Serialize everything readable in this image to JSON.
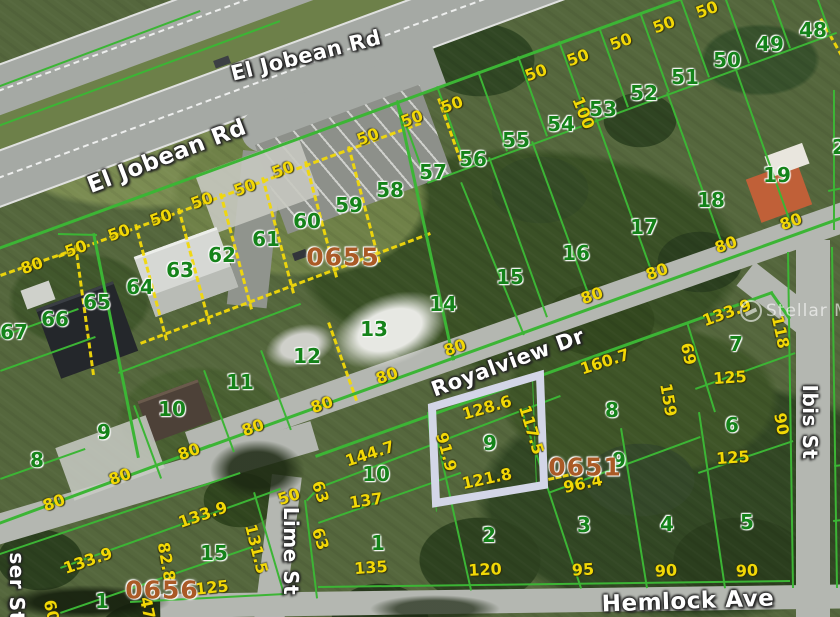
{
  "map": {
    "watermark": {
      "text": "Stellar MLS"
    },
    "colors": {
      "parcel_line_green": "#3cb535",
      "dimension_yellow": "#f2d806",
      "lot_number_green": "#15831a",
      "block_number_brown": "#aa5a26",
      "highlight_border": "#d3d6e7"
    },
    "highlight": {
      "points": "432,407 540,375 544,485 436,503",
      "color": "#d3d6e7",
      "lot": "9"
    },
    "streets": [
      {
        "t": "El Jobean Rd",
        "x": 306,
        "y": 56,
        "r": -14,
        "s": 21
      },
      {
        "t": "El Jobean Rd",
        "x": 167,
        "y": 157,
        "r": -21,
        "s": 23
      },
      {
        "t": "Royalview Dr",
        "x": 508,
        "y": 363,
        "r": -20,
        "s": 21
      },
      {
        "t": "Hemlock Ave",
        "x": 688,
        "y": 602,
        "r": -2,
        "s": 23
      },
      {
        "t": "Lime St",
        "x": 291,
        "y": 551,
        "r": 90,
        "s": 20
      },
      {
        "t": "Ibis St",
        "x": 810,
        "y": 422,
        "r": 90,
        "s": 20
      },
      {
        "t": "ser St",
        "x": 17,
        "y": 587,
        "r": 90,
        "s": 20
      }
    ],
    "block_numbers": [
      {
        "t": "0655",
        "x": 343,
        "y": 257
      },
      {
        "t": "0651",
        "x": 585,
        "y": 467
      },
      {
        "t": "0656",
        "x": 162,
        "y": 590
      }
    ],
    "lot_numbers": [
      {
        "n": "48",
        "x": 813,
        "y": 30
      },
      {
        "n": "49",
        "x": 770,
        "y": 44
      },
      {
        "n": "50",
        "x": 727,
        "y": 60
      },
      {
        "n": "51",
        "x": 685,
        "y": 77
      },
      {
        "n": "52",
        "x": 644,
        "y": 93
      },
      {
        "n": "53",
        "x": 603,
        "y": 109
      },
      {
        "n": "54",
        "x": 561,
        "y": 124
      },
      {
        "n": "55",
        "x": 516,
        "y": 140
      },
      {
        "n": "56",
        "x": 473,
        "y": 159
      },
      {
        "n": "57",
        "x": 433,
        "y": 172
      },
      {
        "n": "58",
        "x": 390,
        "y": 190
      },
      {
        "n": "59",
        "x": 349,
        "y": 205
      },
      {
        "n": "60",
        "x": 307,
        "y": 221
      },
      {
        "n": "61",
        "x": 266,
        "y": 239
      },
      {
        "n": "62",
        "x": 222,
        "y": 255
      },
      {
        "n": "63",
        "x": 180,
        "y": 270
      },
      {
        "n": "64",
        "x": 140,
        "y": 287
      },
      {
        "n": "65",
        "x": 97,
        "y": 302
      },
      {
        "n": "66",
        "x": 55,
        "y": 319
      },
      {
        "n": "67",
        "x": 14,
        "y": 332
      },
      {
        "n": "19",
        "x": 777,
        "y": 175
      },
      {
        "n": "18",
        "x": 711,
        "y": 200
      },
      {
        "n": "17",
        "x": 644,
        "y": 227
      },
      {
        "n": "16",
        "x": 576,
        "y": 253
      },
      {
        "n": "15",
        "x": 510,
        "y": 277
      },
      {
        "n": "14",
        "x": 443,
        "y": 304
      },
      {
        "n": "13",
        "x": 374,
        "y": 329
      },
      {
        "n": "12",
        "x": 307,
        "y": 356
      },
      {
        "n": "11",
        "x": 240,
        "y": 382
      },
      {
        "n": "10",
        "x": 172,
        "y": 409
      },
      {
        "n": "9",
        "x": 104,
        "y": 432
      },
      {
        "n": "8",
        "x": 37,
        "y": 460
      },
      {
        "n": "15",
        "x": 214,
        "y": 553
      },
      {
        "n": "1",
        "x": 102,
        "y": 601
      },
      {
        "n": "10",
        "x": 376,
        "y": 474
      },
      {
        "n": "1",
        "x": 378,
        "y": 543
      },
      {
        "n": "2",
        "x": 489,
        "y": 535
      },
      {
        "n": "9",
        "x": 490,
        "y": 443
      },
      {
        "n": "8",
        "x": 612,
        "y": 410
      },
      {
        "n": "9",
        "x": 619,
        "y": 460
      },
      {
        "n": "3",
        "x": 584,
        "y": 525
      },
      {
        "n": "4",
        "x": 667,
        "y": 524
      },
      {
        "n": "5",
        "x": 747,
        "y": 522
      },
      {
        "n": "7",
        "x": 736,
        "y": 344
      },
      {
        "n": "6",
        "x": 732,
        "y": 425
      },
      {
        "n": "2",
        "x": 839,
        "y": 147
      }
    ],
    "dimensions": [
      {
        "t": "50",
        "x": 707,
        "y": 10,
        "r": -20
      },
      {
        "t": "50",
        "x": 664,
        "y": 25,
        "r": -20
      },
      {
        "t": "50",
        "x": 621,
        "y": 42,
        "r": -20
      },
      {
        "t": "50",
        "x": 578,
        "y": 58,
        "r": -20
      },
      {
        "t": "50",
        "x": 536,
        "y": 73,
        "r": -20
      },
      {
        "t": "100",
        "x": 583,
        "y": 113,
        "r": 68
      },
      {
        "t": "50",
        "x": 452,
        "y": 105,
        "r": -20
      },
      {
        "t": "50",
        "x": 412,
        "y": 119,
        "r": -20
      },
      {
        "t": "50",
        "x": 368,
        "y": 137,
        "r": -20
      },
      {
        "t": "50",
        "x": 283,
        "y": 170,
        "r": -20
      },
      {
        "t": "50",
        "x": 245,
        "y": 188,
        "r": -20
      },
      {
        "t": "50",
        "x": 202,
        "y": 201,
        "r": -20
      },
      {
        "t": "50",
        "x": 161,
        "y": 218,
        "r": -20
      },
      {
        "t": "50",
        "x": 119,
        "y": 233,
        "r": -20
      },
      {
        "t": "50",
        "x": 76,
        "y": 249,
        "r": -20
      },
      {
        "t": "80",
        "x": 32,
        "y": 266,
        "r": -20
      },
      {
        "t": "80",
        "x": 592,
        "y": 296,
        "r": -20
      },
      {
        "t": "80",
        "x": 657,
        "y": 272,
        "r": -20
      },
      {
        "t": "80",
        "x": 726,
        "y": 245,
        "r": -20
      },
      {
        "t": "80",
        "x": 791,
        "y": 222,
        "r": -20
      },
      {
        "t": "80",
        "x": 455,
        "y": 348,
        "r": -20
      },
      {
        "t": "80",
        "x": 387,
        "y": 376,
        "r": -20
      },
      {
        "t": "80",
        "x": 322,
        "y": 405,
        "r": -20
      },
      {
        "t": "80",
        "x": 253,
        "y": 428,
        "r": -20
      },
      {
        "t": "80",
        "x": 189,
        "y": 452,
        "r": -20
      },
      {
        "t": "80",
        "x": 120,
        "y": 477,
        "r": -20
      },
      {
        "t": "80",
        "x": 54,
        "y": 503,
        "r": -20
      },
      {
        "t": "128.6",
        "x": 487,
        "y": 408,
        "r": -16
      },
      {
        "t": "117.5",
        "x": 531,
        "y": 430,
        "r": 73
      },
      {
        "t": "91.9",
        "x": 446,
        "y": 452,
        "r": 75
      },
      {
        "t": "121.8",
        "x": 487,
        "y": 479,
        "r": -12
      },
      {
        "t": "160.7",
        "x": 605,
        "y": 362,
        "r": -18
      },
      {
        "t": "96.4",
        "x": 583,
        "y": 484,
        "r": -12
      },
      {
        "t": "133.9",
        "x": 727,
        "y": 313,
        "r": -20
      },
      {
        "t": "118",
        "x": 780,
        "y": 332,
        "r": 78
      },
      {
        "t": "69",
        "x": 688,
        "y": 354,
        "r": 78
      },
      {
        "t": "125",
        "x": 730,
        "y": 378,
        "r": -4
      },
      {
        "t": "159",
        "x": 668,
        "y": 400,
        "r": 80
      },
      {
        "t": "90",
        "x": 781,
        "y": 424,
        "r": 80
      },
      {
        "t": "125",
        "x": 733,
        "y": 458,
        "r": -4
      },
      {
        "t": "144.7",
        "x": 370,
        "y": 454,
        "r": -18
      },
      {
        "t": "137",
        "x": 366,
        "y": 501,
        "r": -8
      },
      {
        "t": "63",
        "x": 320,
        "y": 492,
        "r": 72
      },
      {
        "t": "63",
        "x": 320,
        "y": 539,
        "r": 72
      },
      {
        "t": "135",
        "x": 371,
        "y": 568,
        "r": -4
      },
      {
        "t": "120",
        "x": 485,
        "y": 570,
        "r": -3
      },
      {
        "t": "50",
        "x": 289,
        "y": 497,
        "r": -18
      },
      {
        "t": "133.9",
        "x": 203,
        "y": 515,
        "r": -19
      },
      {
        "t": "131.5",
        "x": 256,
        "y": 549,
        "r": 76
      },
      {
        "t": "133.9",
        "x": 88,
        "y": 561,
        "r": -19
      },
      {
        "t": "82.8",
        "x": 166,
        "y": 562,
        "r": 80
      },
      {
        "t": "125",
        "x": 212,
        "y": 588,
        "r": -6
      },
      {
        "t": "47",
        "x": 147,
        "y": 608,
        "r": 78
      },
      {
        "t": "60",
        "x": 51,
        "y": 611,
        "r": 78
      },
      {
        "t": "95",
        "x": 583,
        "y": 570,
        "r": -3
      },
      {
        "t": "90",
        "x": 666,
        "y": 571,
        "r": -3
      },
      {
        "t": "90",
        "x": 747,
        "y": 571,
        "r": -3
      }
    ],
    "parcel_lines": [
      [
        -10,
        250,
        690,
        -6,
        3
      ],
      [
        427,
        182,
        836,
        32,
        2
      ],
      [
        -15,
        527,
        210,
        444,
        3
      ],
      [
        200,
        448,
        848,
        214,
        3
      ],
      [
        315,
        455,
        772,
        291,
        3
      ],
      [
        772,
        291,
        791,
        318,
        3
      ],
      [
        -15,
        558,
        240,
        472,
        2
      ],
      [
        255,
        492,
        285,
        594,
        2
      ],
      [
        306,
        500,
        318,
        598,
        2
      ],
      [
        318,
        487,
        560,
        395,
        2
      ],
      [
        306,
        500,
        318,
        487,
        2
      ],
      [
        318,
        522,
        460,
        472,
        2
      ],
      [
        438,
        438,
        472,
        590,
        2
      ],
      [
        522,
        408,
        582,
        588,
        2
      ],
      [
        318,
        586,
        790,
        580,
        2
      ],
      [
        130,
        601,
        285,
        593,
        2
      ],
      [
        789,
        252,
        794,
        588,
        2
      ],
      [
        833,
        247,
        838,
        588,
        2
      ],
      [
        835,
        90,
        835,
        230,
        2
      ],
      [
        828,
        190,
        843,
        187,
        2
      ],
      [
        834,
        465,
        843,
        464,
        2
      ],
      [
        833,
        520,
        843,
        519,
        2
      ],
      [
        398,
        100,
        427,
        180,
        2
      ],
      [
        438,
        86,
        467,
        166,
        2
      ],
      [
        479,
        71,
        508,
        151,
        2
      ],
      [
        519,
        56,
        548,
        136,
        2
      ],
      [
        560,
        41,
        589,
        121,
        2
      ],
      [
        600,
        27,
        629,
        107,
        2
      ],
      [
        641,
        12,
        670,
        92,
        2
      ],
      [
        681,
        -3,
        710,
        77,
        2
      ],
      [
        721,
        -17,
        750,
        63,
        2
      ],
      [
        762,
        -32,
        791,
        48,
        2
      ],
      [
        802,
        -47,
        831,
        33,
        2
      ],
      [
        490,
        157,
        548,
        317,
        2
      ],
      [
        533,
        141,
        592,
        301,
        2
      ],
      [
        597,
        118,
        655,
        278,
        2
      ],
      [
        668,
        92,
        726,
        252,
        2
      ],
      [
        736,
        67,
        793,
        227,
        2
      ],
      [
        462,
        182,
        525,
        335,
        2
      ],
      [
        399,
        102,
        455,
        360,
        3
      ],
      [
        95,
        233,
        140,
        458,
        3
      ],
      [
        58,
        233,
        97,
        234,
        2
      ],
      [
        118,
        372,
        300,
        303,
        2
      ],
      [
        0,
        370,
        95,
        336,
        2
      ],
      [
        0,
        336,
        78,
        308,
        2
      ],
      [
        0,
        478,
        85,
        448,
        2
      ],
      [
        135,
        405,
        162,
        478,
        2
      ],
      [
        205,
        370,
        235,
        452,
        2
      ],
      [
        262,
        350,
        292,
        430,
        2
      ],
      [
        548,
        492,
        700,
        436,
        2
      ],
      [
        698,
        472,
        793,
        440,
        2
      ],
      [
        695,
        388,
        795,
        352,
        2
      ],
      [
        688,
        322,
        716,
        412,
        2
      ],
      [
        622,
        428,
        648,
        588,
        2
      ],
      [
        700,
        412,
        726,
        588,
        2
      ],
      [
        428,
        412,
        437,
        512,
        1.5
      ],
      [
        533,
        377,
        537,
        487,
        1.5
      ],
      [
        436,
        505,
        545,
        486,
        1.5
      ],
      [
        60,
        567,
        280,
        488,
        2
      ],
      [
        60,
        612,
        252,
        546,
        2
      ],
      [
        -10,
        128,
        280,
        20,
        2
      ],
      [
        -8,
        88,
        200,
        10,
        2
      ]
    ],
    "dashed_lines": [
      [
        58,
        255,
        420,
        122
      ],
      [
        137,
        224,
        168,
        340
      ],
      [
        180,
        208,
        211,
        324
      ],
      [
        222,
        193,
        253,
        309
      ],
      [
        264,
        177,
        295,
        293
      ],
      [
        307,
        161,
        338,
        277
      ],
      [
        350,
        146,
        381,
        262
      ],
      [
        140,
        342,
        430,
        232
      ],
      [
        77,
        245,
        95,
        375
      ],
      [
        0,
        274,
        75,
        248
      ],
      [
        822,
        18,
        843,
        55
      ],
      [
        440,
        98,
        462,
        160
      ],
      [
        330,
        322,
        358,
        400
      ],
      [
        548,
        478,
        575,
        472
      ]
    ]
  }
}
